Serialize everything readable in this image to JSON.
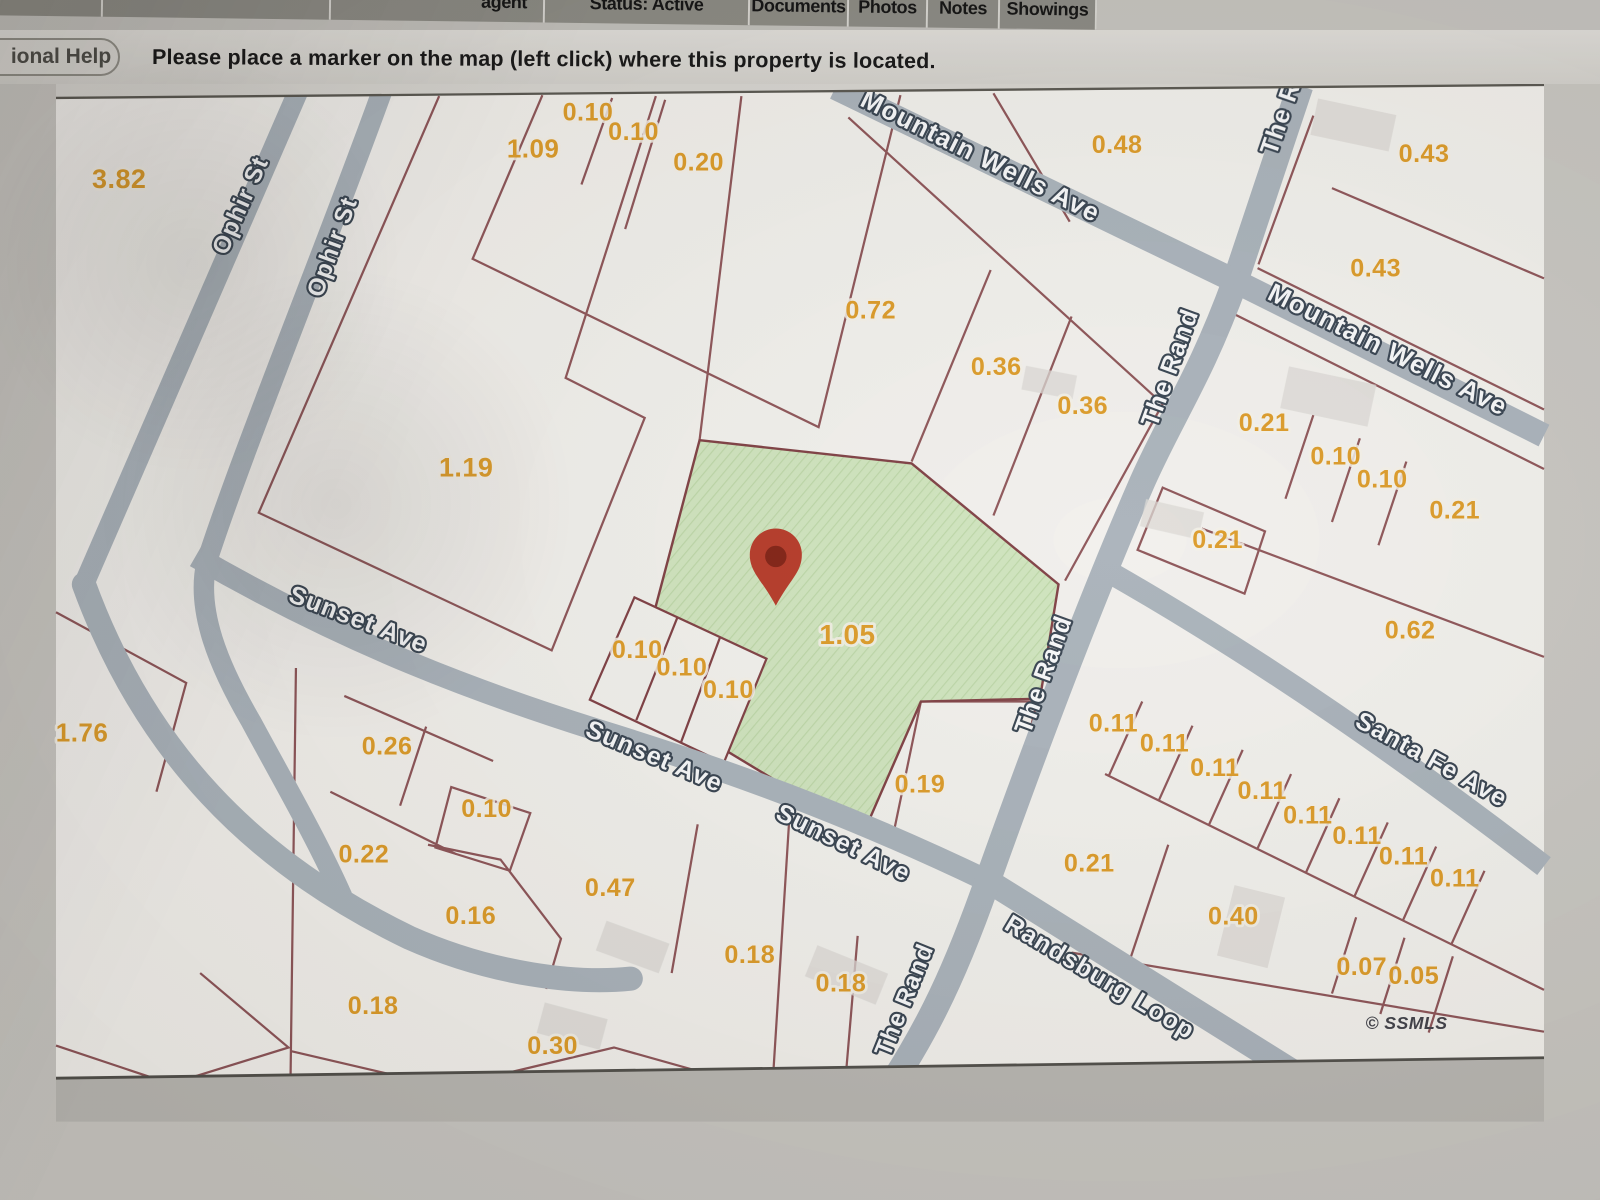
{
  "tab_bar": {
    "tabs": [
      {
        "label": "agent",
        "truncated": true
      },
      {
        "label": "Status: Active",
        "truncated": true
      },
      {
        "label": "Documents"
      },
      {
        "label": "Photos"
      },
      {
        "label": "Notes"
      },
      {
        "label": "Showings"
      }
    ]
  },
  "help_bar": {
    "help_button_label": "ional Help",
    "instruction": "Please place a marker on the map (left click) where this property is located."
  },
  "map": {
    "copyright": "© SSMLS",
    "marker": {
      "type": "location-pin",
      "x": 774,
      "y": 645,
      "color": "#b53826",
      "inner_color": "#801f12"
    },
    "highlight_parcel": {
      "acreage": "1.05",
      "fill": "#cfe4bd"
    },
    "colors": {
      "parcel_line": "#7e3e42",
      "road": "#a9b2ba",
      "acreage_label": "#dc9a26",
      "street_label_fill": "#f7f8f9",
      "street_label_outline": "#36424f",
      "map_background": "#f2f0ec"
    },
    "streets": [
      {
        "name": "Ophir St",
        "x": 206,
        "y": 218,
        "rot": -66,
        "size": 26
      },
      {
        "name": "Ophir St",
        "x": 305,
        "y": 262,
        "rot": -70,
        "size": 26
      },
      {
        "name": "Mountain Wells Ave",
        "x": 990,
        "y": 170,
        "rot": 26.5,
        "size": 28
      },
      {
        "name": "The Rand",
        "x": 1312,
        "y": 162,
        "rot": -71,
        "size": 27,
        "anchor": "start"
      },
      {
        "name": "Mountain Wells Ave",
        "x": 1428,
        "y": 378,
        "rot": 26.5,
        "size": 28
      },
      {
        "name": "The Rand",
        "x": 1206,
        "y": 392,
        "rot": -70,
        "size": 27
      },
      {
        "name": "Sunset Ave",
        "x": 322,
        "y": 668,
        "rot": 21,
        "size": 27
      },
      {
        "name": "The Rand",
        "x": 1070,
        "y": 722,
        "rot": -70,
        "size": 27
      },
      {
        "name": "Sunset Ave",
        "x": 640,
        "y": 815,
        "rot": 23,
        "size": 27
      },
      {
        "name": "Santa Fe Ave",
        "x": 1475,
        "y": 818,
        "rot": 29,
        "size": 27
      },
      {
        "name": "Sunset Ave",
        "x": 843,
        "y": 908,
        "rot": 26,
        "size": 27
      },
      {
        "name": "Randsburg Loop",
        "x": 1118,
        "y": 1052,
        "rot": 31,
        "size": 27
      },
      {
        "name": "The Rand",
        "x": 920,
        "y": 1072,
        "rot": -68,
        "size": 26
      }
    ],
    "parcels": [
      {
        "value": "3.82",
        "x": 68,
        "y": 196,
        "size": 29
      },
      {
        "value": "0.10",
        "x": 572,
        "y": 123
      },
      {
        "value": "0.10",
        "x": 621,
        "y": 144
      },
      {
        "value": "1.09",
        "x": 513,
        "y": 163,
        "size": 28
      },
      {
        "value": "0.20",
        "x": 691,
        "y": 177
      },
      {
        "value": "0.48",
        "x": 1141,
        "y": 158
      },
      {
        "value": "0.43",
        "x": 1471,
        "y": 168
      },
      {
        "value": "0.43",
        "x": 1419,
        "y": 291
      },
      {
        "value": "0.72",
        "x": 876,
        "y": 336
      },
      {
        "value": "0.36",
        "x": 1011,
        "y": 397
      },
      {
        "value": "0.36",
        "x": 1104,
        "y": 439
      },
      {
        "value": "0.21",
        "x": 1299,
        "y": 457
      },
      {
        "value": "0.10",
        "x": 1376,
        "y": 493
      },
      {
        "value": "0.10",
        "x": 1426,
        "y": 518
      },
      {
        "value": "1.19",
        "x": 441,
        "y": 506,
        "size": 29
      },
      {
        "value": "0.21",
        "x": 1504,
        "y": 551
      },
      {
        "value": "0.21",
        "x": 1249,
        "y": 583
      },
      {
        "value": "0.62",
        "x": 1456,
        "y": 680
      },
      {
        "value": "1.05",
        "x": 851,
        "y": 686,
        "size": 30
      },
      {
        "value": "0.10",
        "x": 625,
        "y": 701
      },
      {
        "value": "0.10",
        "x": 673,
        "y": 720
      },
      {
        "value": "0.10",
        "x": 723,
        "y": 744
      },
      {
        "value": "1.76",
        "x": 28,
        "y": 791,
        "size": 28
      },
      {
        "value": "0.26",
        "x": 356,
        "y": 805
      },
      {
        "value": "0.11",
        "x": 1137,
        "y": 780
      },
      {
        "value": "0.11",
        "x": 1192,
        "y": 802
      },
      {
        "value": "0.11",
        "x": 1246,
        "y": 828
      },
      {
        "value": "0.19",
        "x": 929,
        "y": 846
      },
      {
        "value": "0.11",
        "x": 1297,
        "y": 853
      },
      {
        "value": "0.10",
        "x": 463,
        "y": 872
      },
      {
        "value": "0.11",
        "x": 1346,
        "y": 879
      },
      {
        "value": "0.11",
        "x": 1399,
        "y": 901
      },
      {
        "value": "0.22",
        "x": 331,
        "y": 921
      },
      {
        "value": "0.21",
        "x": 1111,
        "y": 931
      },
      {
        "value": "0.11",
        "x": 1449,
        "y": 923
      },
      {
        "value": "0.11",
        "x": 1504,
        "y": 947
      },
      {
        "value": "0.47",
        "x": 596,
        "y": 957
      },
      {
        "value": "0.16",
        "x": 446,
        "y": 987
      },
      {
        "value": "0.40",
        "x": 1266,
        "y": 988
      },
      {
        "value": "0.18",
        "x": 746,
        "y": 1029
      },
      {
        "value": "0.07",
        "x": 1404,
        "y": 1042
      },
      {
        "value": "0.05",
        "x": 1460,
        "y": 1052
      },
      {
        "value": "0.18",
        "x": 844,
        "y": 1060
      },
      {
        "value": "0.18",
        "x": 341,
        "y": 1084
      },
      {
        "value": "0.30",
        "x": 534,
        "y": 1127
      }
    ]
  }
}
